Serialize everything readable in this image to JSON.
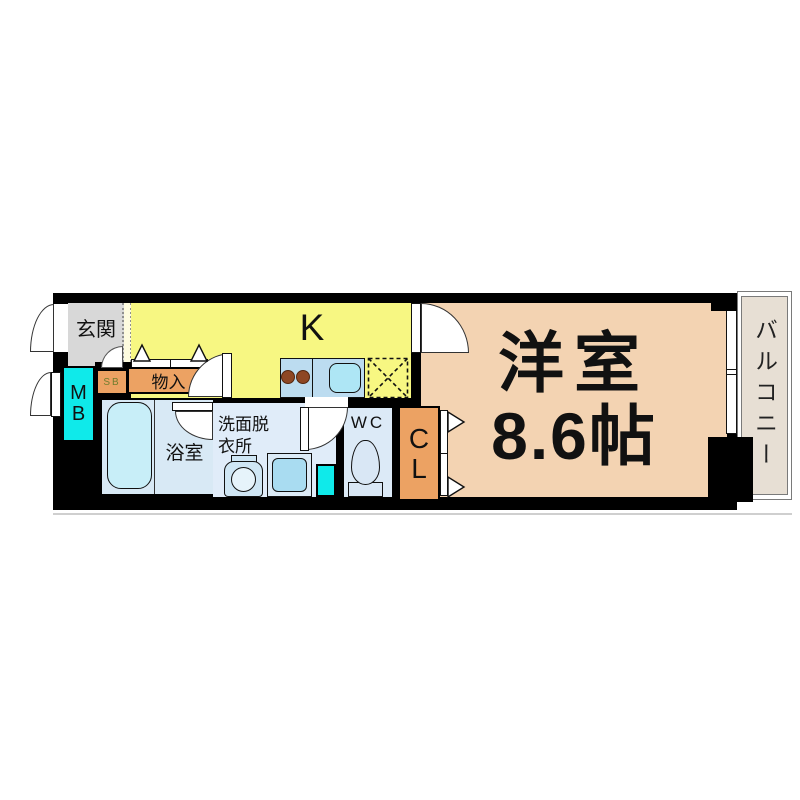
{
  "floorplan": {
    "rooms": {
      "genkan": {
        "label": "玄関"
      },
      "kitchen": {
        "label": "K"
      },
      "western_room": {
        "label_line1": "洋室",
        "label_line2": "8.6帖"
      },
      "balcony": {
        "label": "バルコニー"
      },
      "bathroom": {
        "label": "浴室"
      },
      "washroom": {
        "label_line1": "洗面脱",
        "label_line2": "衣所"
      },
      "toilet_room": {
        "label": "WC"
      },
      "closet": {
        "letter1": "C",
        "letter2": "L"
      },
      "storage": {
        "label": "物入"
      },
      "shoe_box": {
        "label": "SB"
      },
      "meter_box": {
        "letter1": "M",
        "letter2": "B"
      }
    },
    "colors": {
      "wall": "#000000",
      "genkan_floor": "#d8d8d8",
      "kitchen_floor": "#f7f782",
      "western_room_floor": "#f3d3b2",
      "balcony_floor": "#e7dfd4",
      "closet_orange": "#eca263",
      "meter_box_cyan": "#0feaea",
      "wet_area_blue": "#dceaf7",
      "bathtub_blue": "#c8eef8",
      "burner_brown": "#8e4724",
      "shoe_box_text_green": "#6f7d2e"
    },
    "fixtures": [
      "bathtub",
      "kitchen-counter",
      "gas-burners",
      "kitchen-sink",
      "refrigerator-space",
      "washing-machine-pan",
      "wash-basin",
      "toilet",
      "sliding-window",
      "pipe-space",
      "door-swing",
      "folding-door-markers"
    ]
  }
}
